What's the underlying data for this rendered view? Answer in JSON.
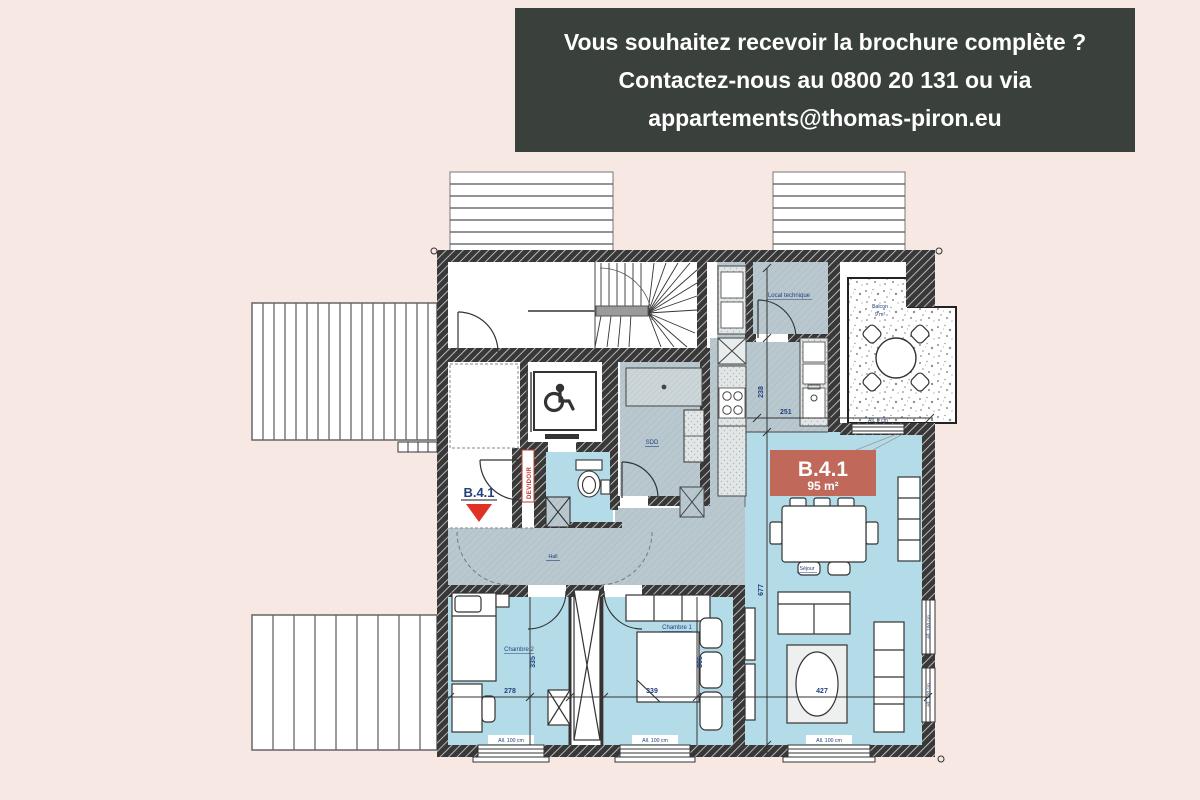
{
  "banner": {
    "lines": [
      "Vous souhaitez recevoir la brochure complète ?",
      "Contactez-nous au 0800 20 131 ou via",
      "appartements@thomas-piron.eu"
    ],
    "bg_color": "#3a403b",
    "text_color": "#ffffff"
  },
  "plan": {
    "badge": {
      "id": "B.4.1",
      "area": "95 m²",
      "bg": "#c0695a"
    },
    "marker": {
      "label": "B.4.1"
    },
    "labels": {
      "local_technique": "Local technique",
      "hall": "Hall",
      "sdd": "SDD",
      "sejour": "Séjour",
      "chambre1": "Chambre 1",
      "chambre2": "Chambre 2",
      "balcon": "Balcon",
      "balcon_area": "9 m²",
      "devidoir": "DEVIDOIR"
    },
    "dims": {
      "d238": "238",
      "d251": "251",
      "d677": "677",
      "d278": "278",
      "d335": "335",
      "d339": "339",
      "d365": "365",
      "d427": "427"
    },
    "windows": {
      "w100": "All. 100 cm",
      "w0": "All. 0 cm"
    },
    "colors": {
      "background": "#f7e8e3",
      "wall": "#383838",
      "floor_gray": "#b9c8ce",
      "room_blue": "#b4dce8",
      "badge_red": "#c0695a",
      "marker_red": "#e03127",
      "label_navy": "#23407c"
    }
  }
}
